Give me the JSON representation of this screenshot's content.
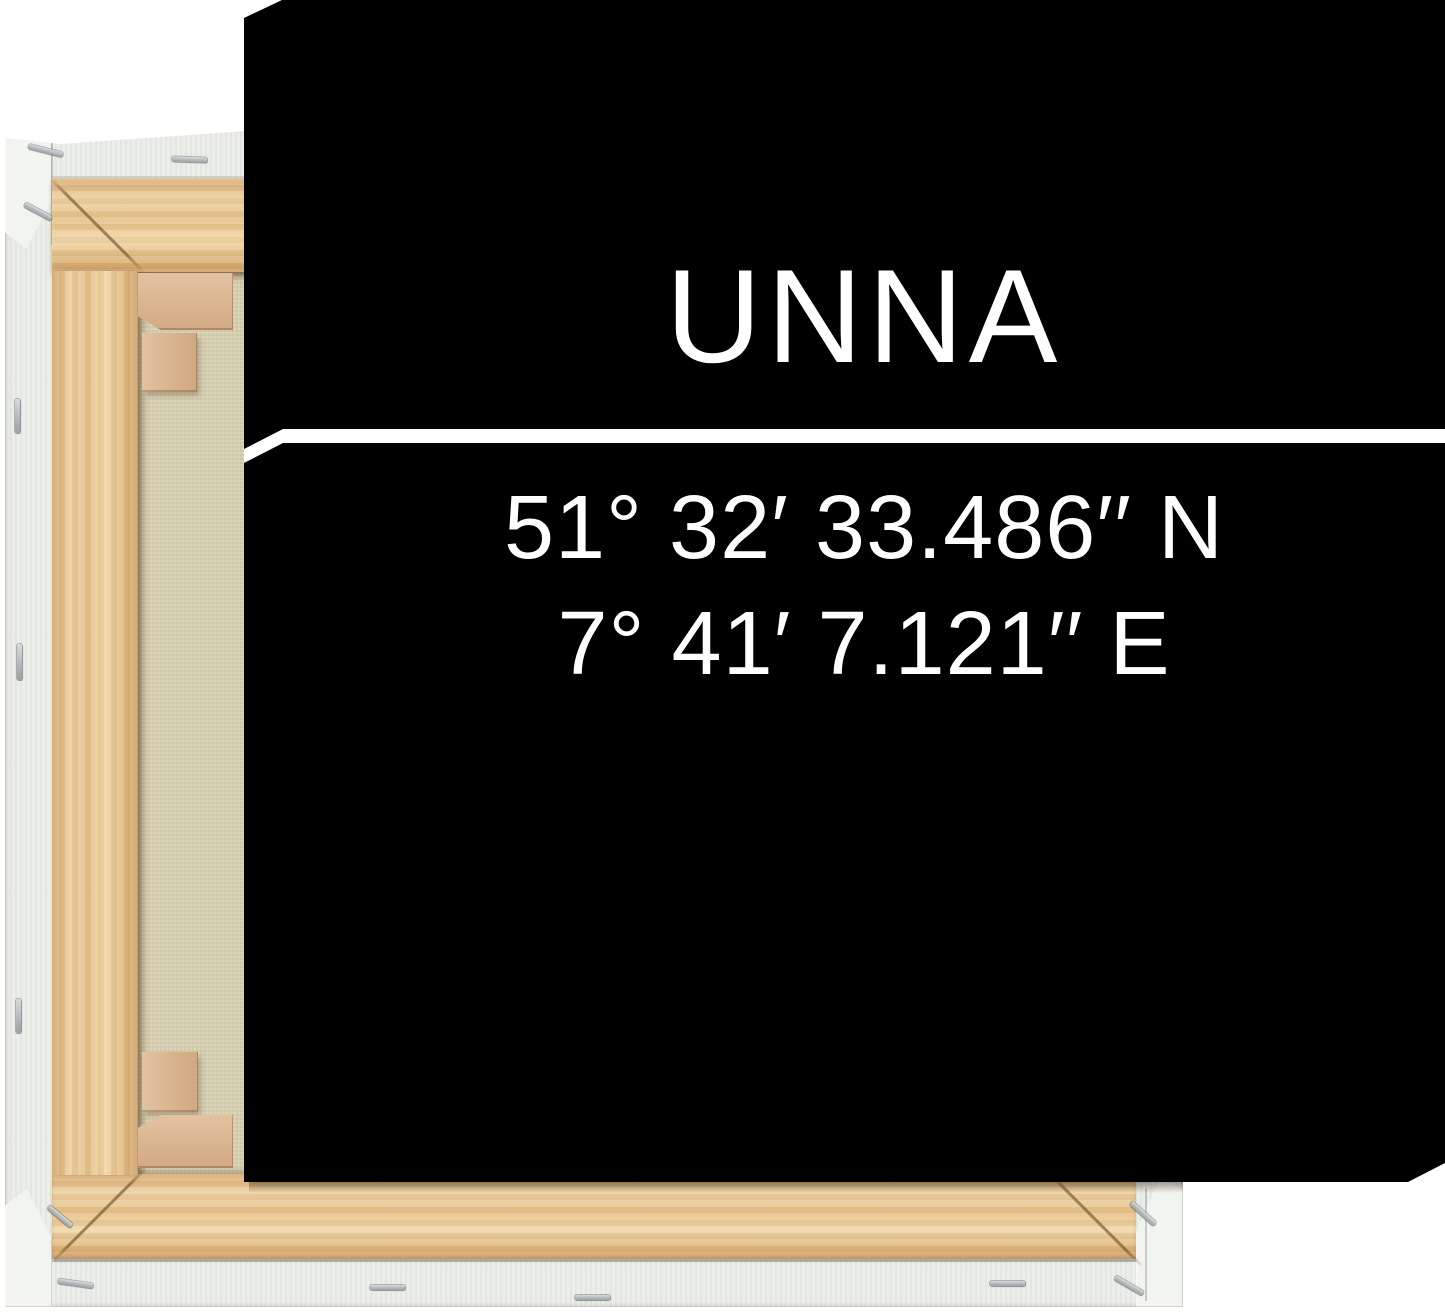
{
  "artwork": {
    "city": "UNNA",
    "latitude": "51° 32′ 33.486′′ N",
    "longitude": "7° 41′ 7.121′′ E"
  },
  "colors": {
    "background": "#ffffff",
    "canvas_front": "#000000",
    "design_text": "#ffffff",
    "divider_line": "#ffffff",
    "wood_light": "#f1d8aa",
    "wood_mid": "#e6c28a",
    "wood_shadow": "#cfa068",
    "wedge_wood": "#d9b493",
    "canvas_back_beige": "#d8d0b2",
    "canvas_wrap_white": "#eaede8",
    "staple": "#b9bec1"
  }
}
